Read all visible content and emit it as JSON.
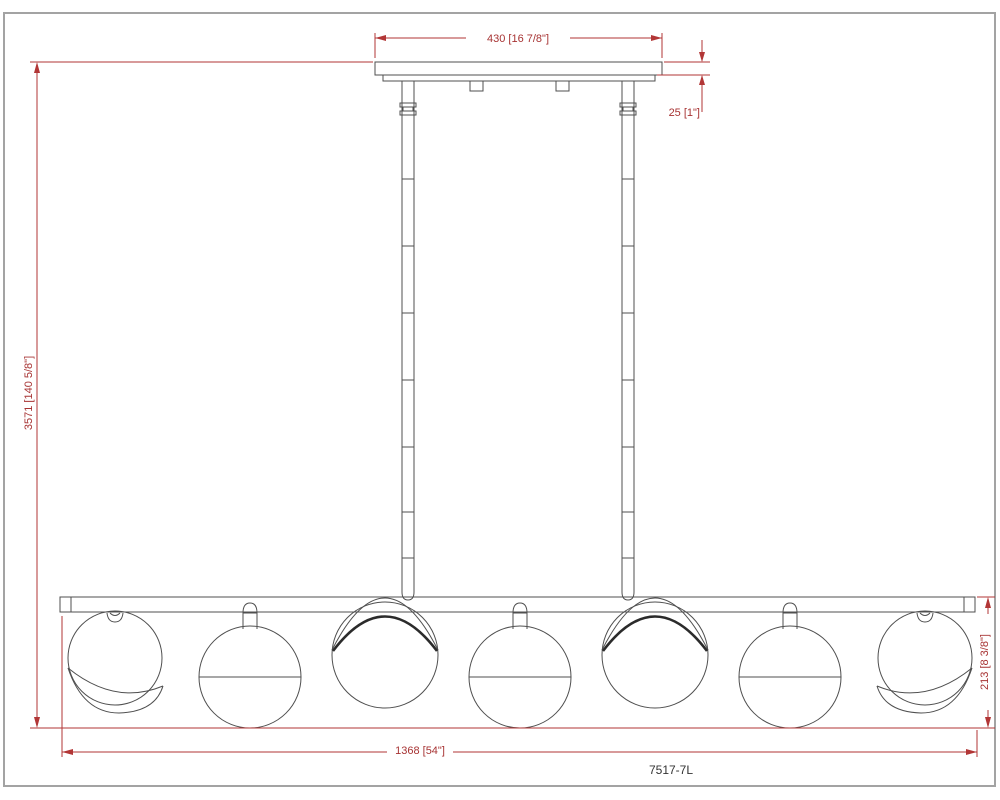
{
  "drawing": {
    "model": "7517-7L",
    "globe_count": 7,
    "dimensions": {
      "canopy_width": "430 [16 7/8\"]",
      "canopy_thickness": "25 [1\"]",
      "overall_height": "3571 [140 5/8\"]",
      "bar_length": "1368 [54\"]",
      "fixture_height": "213 [8 3/8\"]"
    },
    "colors": {
      "dimension_line": "#b23636",
      "dimension_text": "#a73333",
      "drawing_line": "#4f4f4f",
      "page_border": "#a3a3a3"
    }
  }
}
